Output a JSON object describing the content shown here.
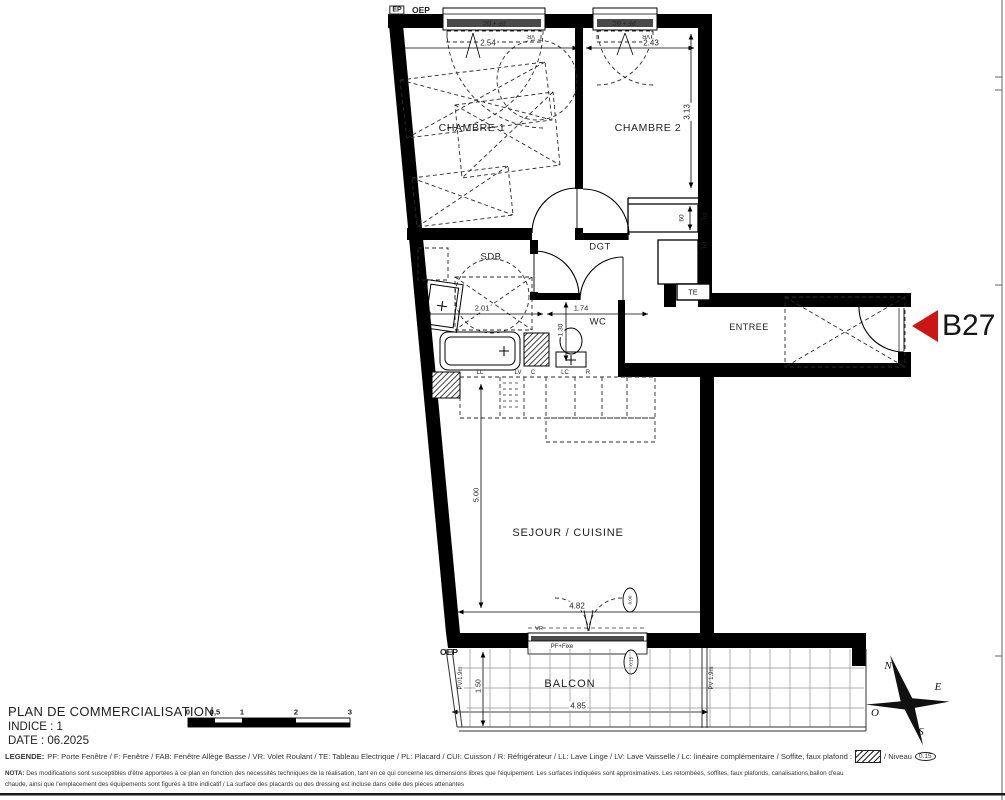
{
  "meta": {
    "title": "PLAN DE COMMERCIALISATION",
    "indice": "INDICE : 1",
    "date": "DATE :  06.2025"
  },
  "unit": {
    "label": "B27",
    "arrow_color": "#cc1616"
  },
  "rooms": {
    "chambre1": "CHAMBRE 1",
    "chambre2": "CHAMBRE 2",
    "sdb": "SDB",
    "dgt": "DGT",
    "wc": "WC",
    "entree": "ENTREE",
    "sejour": "SEJOUR / CUISINE",
    "balcon": "BALCON"
  },
  "dimensions": {
    "chambre1_width": "2.54",
    "chambre2_width": "2.43",
    "chambre2_height": "3.13",
    "placard_depth": "60",
    "sdb_width": "2.01",
    "wc_width": "1.74",
    "wc_depth": "1.30",
    "sejour_height": "5.00",
    "sejour_width": "4.82",
    "balcon_width": "4.85",
    "balcon_depth": "1.50"
  },
  "labels": {
    "ep": "EP",
    "oep": "OEP",
    "pf_gc": "PF + GC",
    "vr": "VR",
    "pf_fixe": "PF+Fixe",
    "pl": "PL",
    "te": "TE",
    "ll": "LL",
    "lv": "LV",
    "c": "C",
    "lc": "LC",
    "r": "R",
    "pv_left": "PV/1.9m",
    "pv_right": "PV 1.9m"
  },
  "levels": {
    "interior": "0.00",
    "balcony": "-0.15",
    "legend_sample": "0.15"
  },
  "compass": {
    "n": "N",
    "e": "E",
    "s": "S",
    "o": "O"
  },
  "scalebar": {
    "ticks": [
      "0",
      "0,5",
      "1",
      "2",
      "3"
    ]
  },
  "legend": {
    "label": "LEGENDE:",
    "text": "PF: Porte Fenêtre / F: Fenêtre / FAB: Fenêtre Allège Basse / VR: Volet Roulant / TE: Tableau Electrique / PL: Placard / CUI: Cuisson / R: Réfrigérateur / LL: Lave Linge / LV: Lave Vaisselle / Lc: linéaire complémentaire / Soffite, faux plafond :",
    "niveau": "/ Niveau"
  },
  "nota": {
    "label": "NOTA:",
    "line1": "Des modifications sont susceptibles d'être apportées à ce plan en fonction des nécessités techniques de la réalisation, tant en ce qui concerne les dimensions libres que l'équipement. Les surfaces indiquées sont approximatives. Les retombées, soffites, faux plafonds, canalisations,ballon d'eau",
    "line2": "chaude, ainsi que l'emplacement des équipements sont figurés à titre indicatif / La surface des placards ou des dressing est incluse dans celle des pièces attenantes"
  }
}
